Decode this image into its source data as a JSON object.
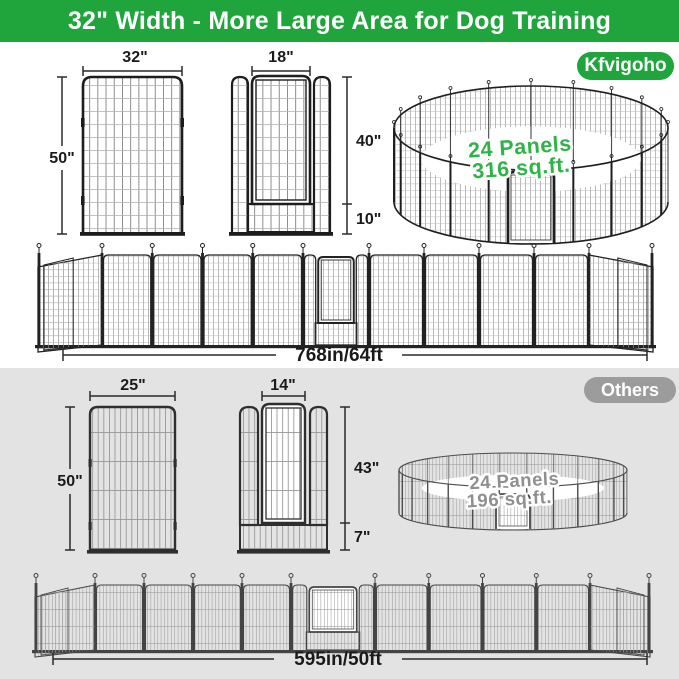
{
  "header": {
    "title": "32\" Width - More Large Area for Dog Training",
    "bg_color": "#1fa53c",
    "text_color": "#ffffff"
  },
  "kfvigoho": {
    "badge_label": "Kfvigoho",
    "badge_color": "#1fa53c",
    "panel": {
      "width_label": "32\"",
      "height_label": "50\""
    },
    "door_panel": {
      "door_width_label": "18\"",
      "door_height_label": "40\"",
      "bottom_height_label": "10\""
    },
    "pen": {
      "panels_label": "24 Panels",
      "area_label": "316 sq.ft.",
      "text_color": "#2fb348"
    },
    "layout_total_label": "768in/64ft"
  },
  "others": {
    "badge_label": "Others",
    "badge_color": "#9c9c9c",
    "section_bg": "#e3e3e3",
    "panel": {
      "width_label": "25\"",
      "height_label": "50\""
    },
    "door_panel": {
      "door_width_label": "14\"",
      "door_height_label": "43\"",
      "bottom_height_label": "7\""
    },
    "pen": {
      "panels_label": "24 Panels",
      "area_label": "196 sq.ft.",
      "text_color": "#8f8f8f"
    },
    "layout_total_label": "595in/50ft"
  }
}
